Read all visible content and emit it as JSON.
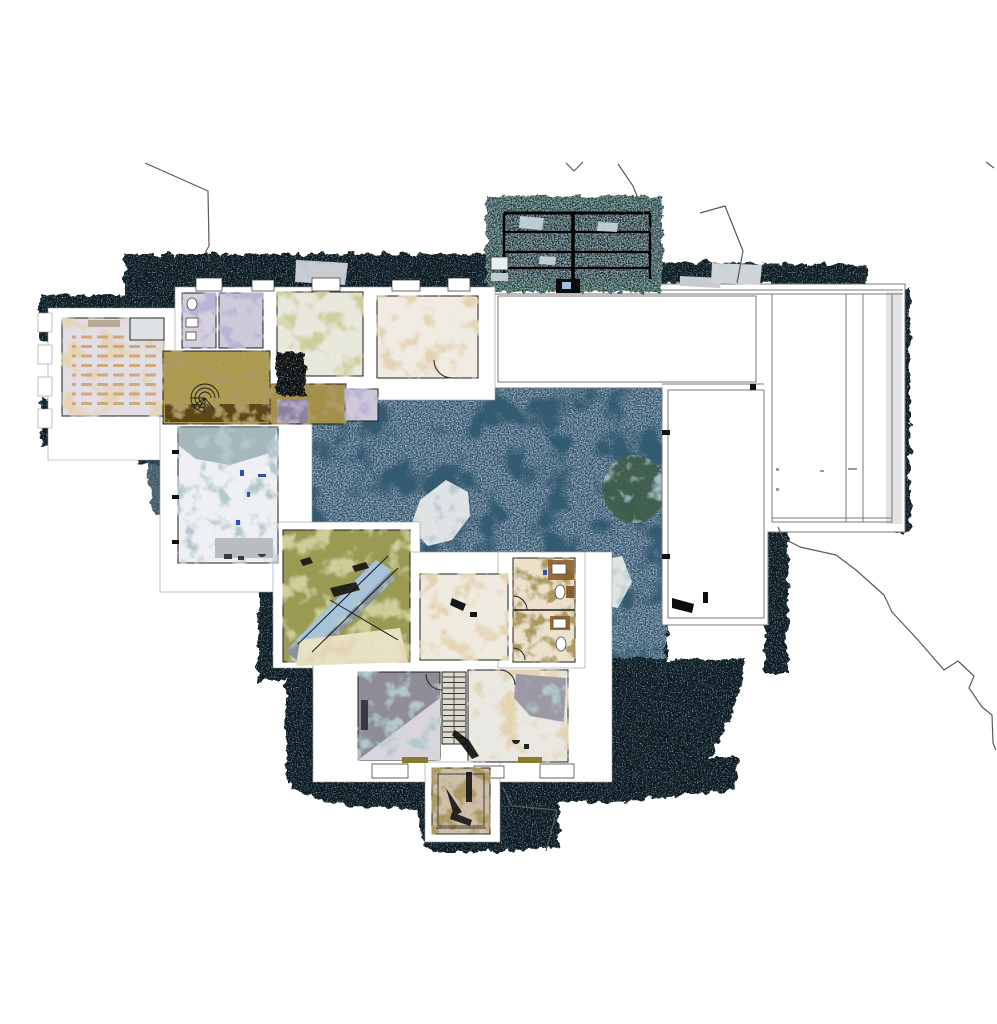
{
  "scene": {
    "type": "point-cloud-floorplan-orthophoto",
    "description": "Top-down orthographic slice of a terrestrial laser-scan point cloud showing the ground floor of a building complex: chapel wing (left), north wing with small rooms, glass conservatory (top), large white unscanned roof area (right), dark speckled courtyard (center), garden room with glass reflections, bottom wing with staircase and entrance porch, and thin site-boundary polylines.",
    "regions": [
      "site-boundary-lines",
      "glasshouse-roof",
      "dark-scan-surround",
      "chapel-room",
      "north-wing-rooms",
      "spiral-stair-hall",
      "left-wing-room",
      "conservatory-garden-room",
      "courtyard",
      "roof-outline-area",
      "inner-white-room",
      "mid-bathroom-block",
      "bottom-wing-rooms",
      "staircase",
      "entrance-porch"
    ]
  },
  "palette": {
    "background": "#ffffff",
    "ink_dark": "#0c1a24",
    "speckle_blue": "#7fa9cc",
    "courtyard_base": "#2e4f66",
    "glass_teal": "#16302b",
    "glass_frame_dark": "#131f27",
    "roof_white": "#ffffff",
    "outline_gray": "#787878",
    "wall_line": "#1c1c1c",
    "site_line": "#5a5a5a",
    "chapel_floor": "#e3dde4",
    "pew_tan": "#c9a06a",
    "hall_olive": "#ac9c50",
    "hall_brown": "#5b4418",
    "room_lavender": "#d6d0dc",
    "room_purple": "#cfc9dc",
    "room_olivewhite": "#e9e8dd",
    "room_cream": "#f0ebe3",
    "left_room_white": "#eef0f3",
    "conservatory_olive": "#9b9a52",
    "glass_streak_blue": "#a9c9e2",
    "streak_gray": "#8a9298",
    "cream_patch": "#e7e1c5",
    "gray_room": "#8f8c96",
    "room_b_white": "#eae8e3",
    "gray_patch": "#9c99a4",
    "stair_tread": "#ddd8cc",
    "bath_cream": "#ece2cc",
    "fixture_brown": "#8a5a28",
    "porch_base": "#cdbfa8",
    "bush_green": "#3e5c44",
    "light_patch": "#dfe3e4",
    "fringe_gray": "#d9dde0",
    "blue_tick": "#3050b0"
  }
}
